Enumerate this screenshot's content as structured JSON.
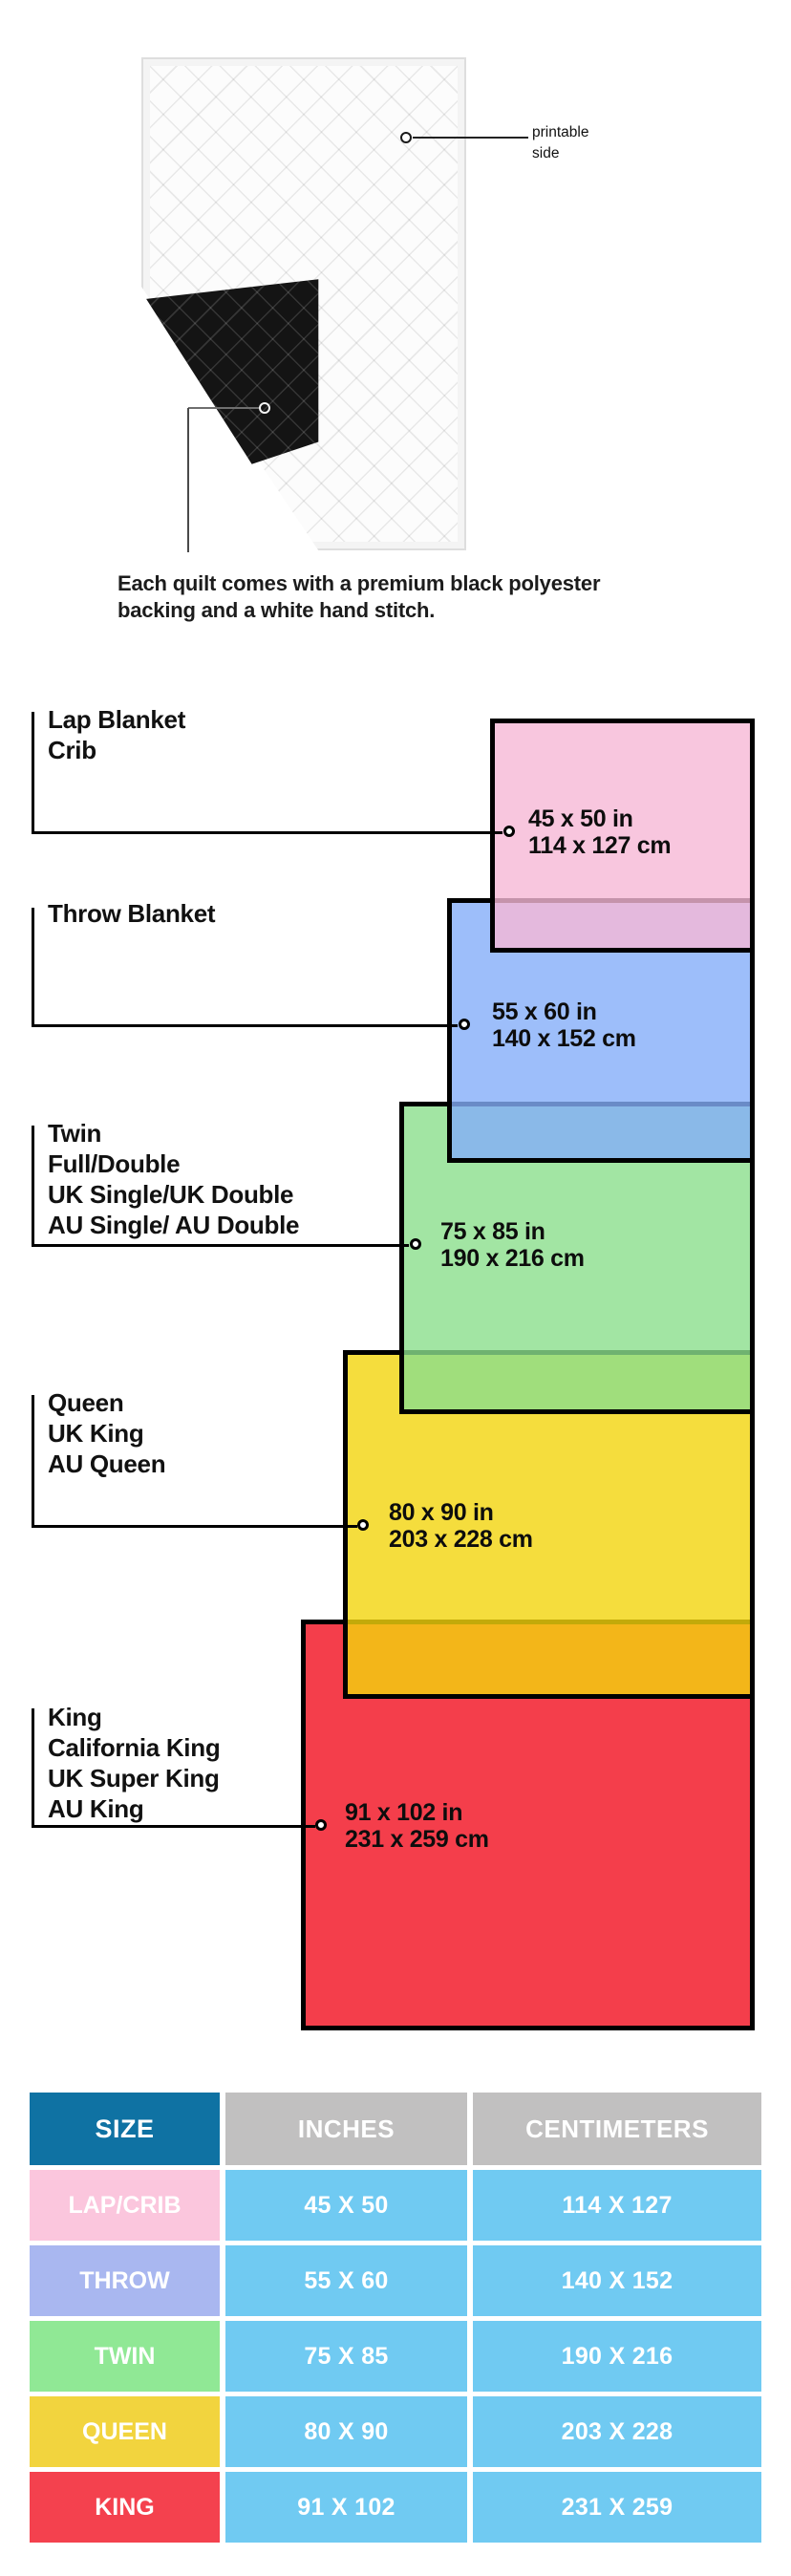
{
  "hero": {
    "printable_label_line1": "printable",
    "printable_label_line2": "side",
    "caption_line1": "Each quilt comes with a premium black polyester",
    "caption_line2": "backing and a white hand stitch."
  },
  "diagram": {
    "sizes": [
      {
        "id": "lap",
        "labels": [
          "Lap Blanket",
          "Crib"
        ],
        "inches": "45 x 50 in",
        "cm": "114 x 127 cm",
        "color": "#fbc6de"
      },
      {
        "id": "throw",
        "labels": [
          "Throw Blanket"
        ],
        "inches": "55 x 60 in",
        "cm": "140 x 152 cm",
        "color": "#a0c3fa"
      },
      {
        "id": "twin",
        "labels": [
          "Twin",
          "Full/Double",
          "UK Single/UK Double",
          "AU Single/ AU Double"
        ],
        "inches": "75 x 85 in",
        "cm": "190 x 216 cm",
        "color": "#98e899"
      },
      {
        "id": "queen",
        "labels": [
          "Queen",
          "UK King",
          "AU Queen"
        ],
        "inches": "80 x 90 in",
        "cm": "203 x 228 cm",
        "color": "#f4da3d"
      },
      {
        "id": "king",
        "labels": [
          "King",
          "California King",
          "UK Super King",
          "AU King"
        ],
        "inches": "91 x 102 in",
        "cm": "231 x 259 cm",
        "color": "#f4424f"
      }
    ],
    "overlap_colors": {
      "pink_over_blue": "#e3b9e6",
      "blue_over_green": "#85bcdf",
      "green_over_yellow": "#97dc57",
      "yellow_over_red": "#f3ab1b"
    }
  },
  "table": {
    "headers": [
      "SIZE",
      "INCHES",
      "CENTIMETERS"
    ],
    "rows": [
      {
        "size": "LAP/CRIB",
        "inches": "45 X 50",
        "cm": "114 X 127",
        "color": "#fbc6dd"
      },
      {
        "size": "THROW",
        "inches": "55 X 60",
        "cm": "140 X 152",
        "color": "#a9b7f0"
      },
      {
        "size": "TWIN",
        "inches": "75 X 85",
        "cm": "190 X 216",
        "color": "#90e895"
      },
      {
        "size": "QUEEN",
        "inches": "80 X 90",
        "cm": "203 X 228",
        "color": "#f2d43e"
      },
      {
        "size": "KING",
        "inches": "91 X 102",
        "cm": "231 X 259",
        "color": "#f4414e"
      }
    ],
    "colors": {
      "header_size_bg": "#0f72a3",
      "header_gray_bg": "#c1c0c0",
      "data_cell_bg": "#70caf2",
      "cell_text": "#ffffff"
    }
  }
}
